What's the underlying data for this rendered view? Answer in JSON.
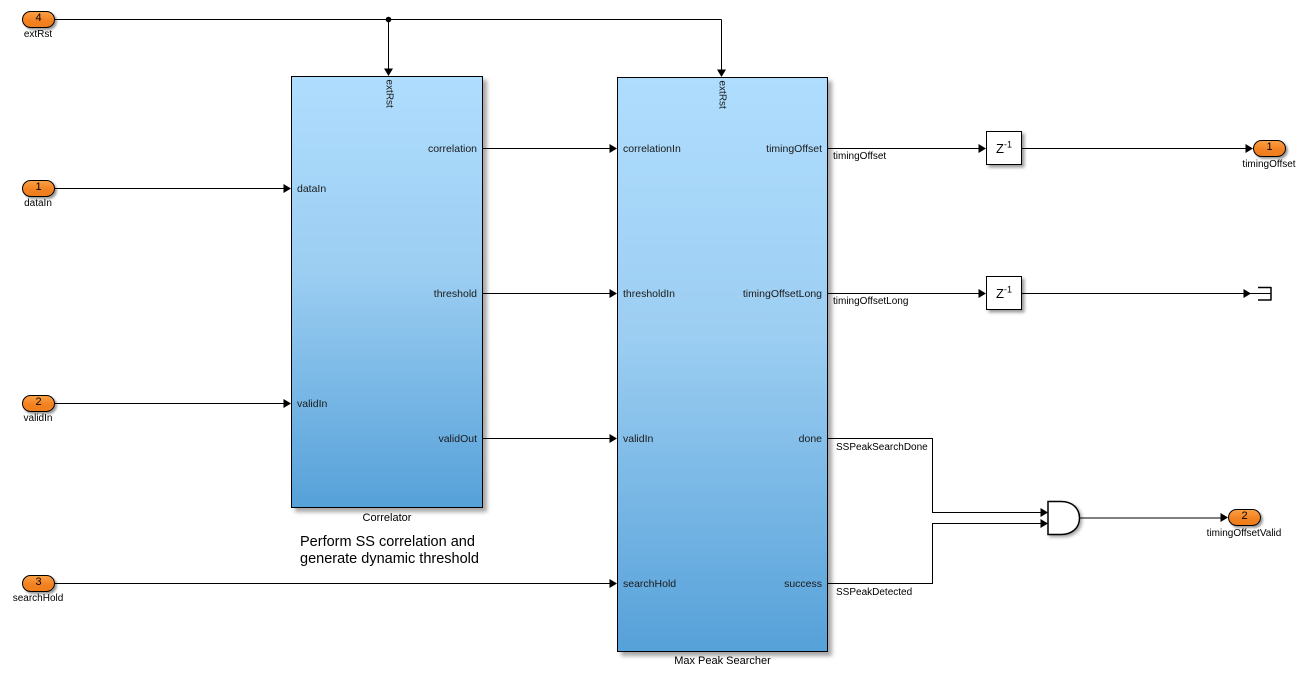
{
  "ports": {
    "inputs": [
      {
        "num": "4",
        "label": "extRst"
      },
      {
        "num": "1",
        "label": "dataIn"
      },
      {
        "num": "2",
        "label": "validIn"
      },
      {
        "num": "3",
        "label": "searchHold"
      }
    ],
    "outputs": [
      {
        "num": "1",
        "label": "timingOffset"
      },
      {
        "num": "2",
        "label": "timingOffsetValid"
      }
    ]
  },
  "blocks": {
    "correlator": {
      "name": "Correlator",
      "top_label": "extRst",
      "in": [
        "dataIn",
        "validIn"
      ],
      "out": [
        "correlation",
        "threshold",
        "validOut"
      ]
    },
    "max_peak_searcher": {
      "name": "Max Peak Searcher",
      "top_label": "extRst",
      "in": [
        "correlationIn",
        "thresholdIn",
        "validIn",
        "searchHold"
      ],
      "out": [
        "timingOffset",
        "timingOffsetLong",
        "done",
        "success"
      ]
    },
    "delay1": {
      "base": "Z",
      "exp": "-1"
    },
    "delay2": {
      "base": "Z",
      "exp": "-1"
    }
  },
  "signals": {
    "timingOffset": "timingOffset",
    "timingOffsetLong": "timingOffsetLong",
    "done": "SSPeakSearchDone",
    "success": "SSPeakDetected"
  },
  "annotation": {
    "line1": "Perform SS correlation and",
    "line2": "generate dynamic threshold"
  },
  "colors": {
    "block_gradient_top": "#AFDDFE",
    "block_gradient_bottom": "#56A1D9",
    "port_orange": "#F28222",
    "wire": "#000000",
    "background": "#FFFFFF"
  }
}
